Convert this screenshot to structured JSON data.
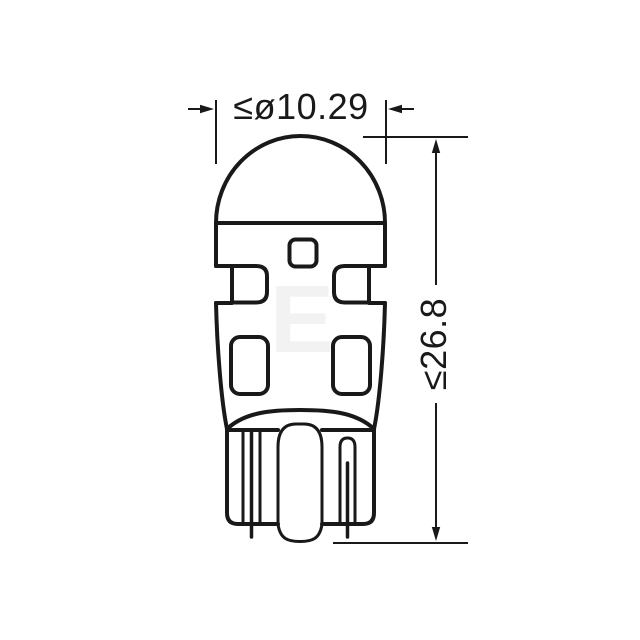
{
  "page": {
    "background": "#ffffff"
  },
  "drawing": {
    "description": "Technical outline drawing of a wedge-base (W5W-style) LED bulb, front view, with maximum overall dimensions",
    "line_color": "#191919",
    "watermark": {
      "text": "E",
      "color": "#f2f2f2"
    },
    "dimensions": {
      "diameter": {
        "label": "≤ø10.29",
        "value": 10.29
      },
      "height": {
        "label": "≤26.8",
        "value": 26.8
      }
    }
  }
}
